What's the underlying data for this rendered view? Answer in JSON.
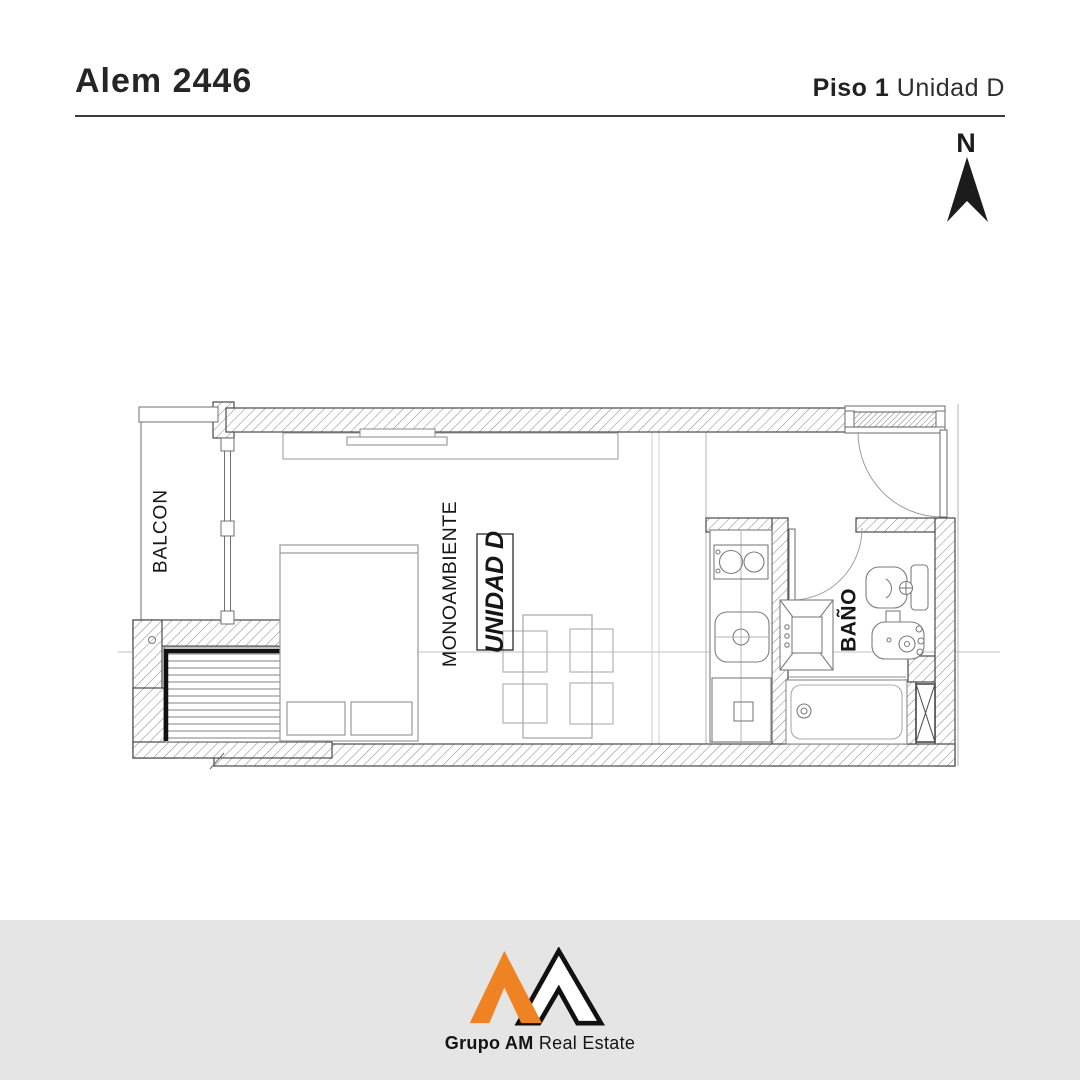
{
  "header": {
    "building": "Alem 2446",
    "floor": "Piso 1",
    "unit": "Unidad D"
  },
  "compass": {
    "label": "N"
  },
  "plan": {
    "rooms": {
      "balcony": "BALCON",
      "studio": "MONOAMBIENTE",
      "unit_tag": "UNIDAD D",
      "bathroom": "BAÑO"
    }
  },
  "footer": {
    "brand_strong": "Grupo AM",
    "brand_light": "Real Estate"
  },
  "colors": {
    "accent": "#ef8222",
    "footer_bg": "#e5e5e5",
    "ink": "#1d1d1d",
    "wall_line": "#4a4a4a",
    "furniture_line": "#999999"
  }
}
